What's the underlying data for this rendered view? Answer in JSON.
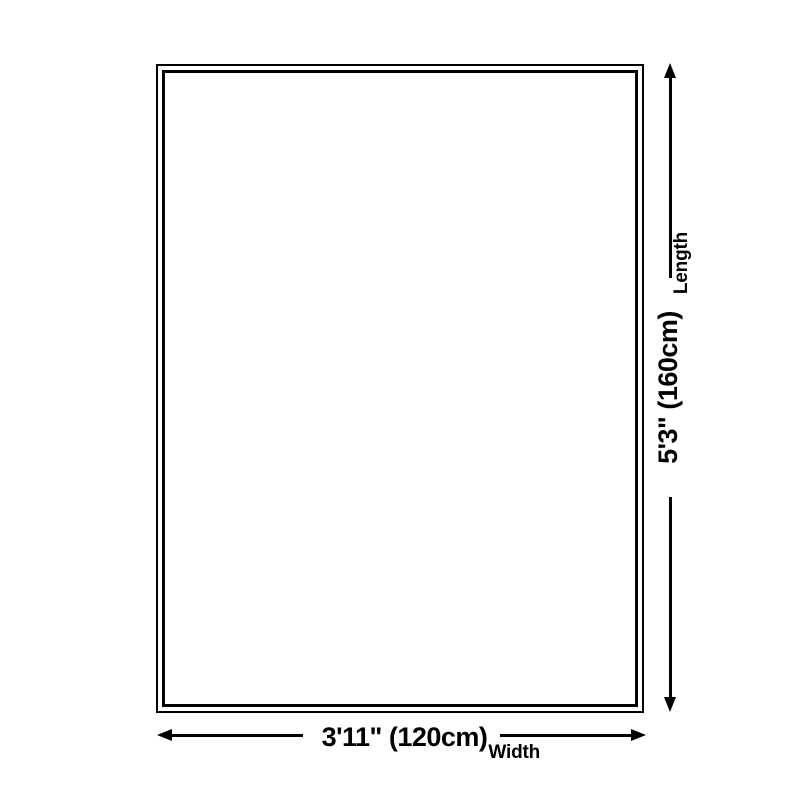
{
  "diagram": {
    "kind": "product-size-diagram",
    "shape": "rectangle"
  },
  "width_dimension": {
    "value": "3'11\" (120cm)",
    "axis_label": "Width"
  },
  "length_dimension": {
    "value": "5'3\" (160cm)",
    "axis_label": "Length"
  },
  "icons": {
    "width_start": "arrow-left-icon",
    "width_end": "arrow-right-icon",
    "length_bottom": "arrow-down-icon",
    "length_top": "arrow-up-icon"
  },
  "colors": {
    "line": "#000000",
    "text": "#000000",
    "background": "#ffffff"
  }
}
